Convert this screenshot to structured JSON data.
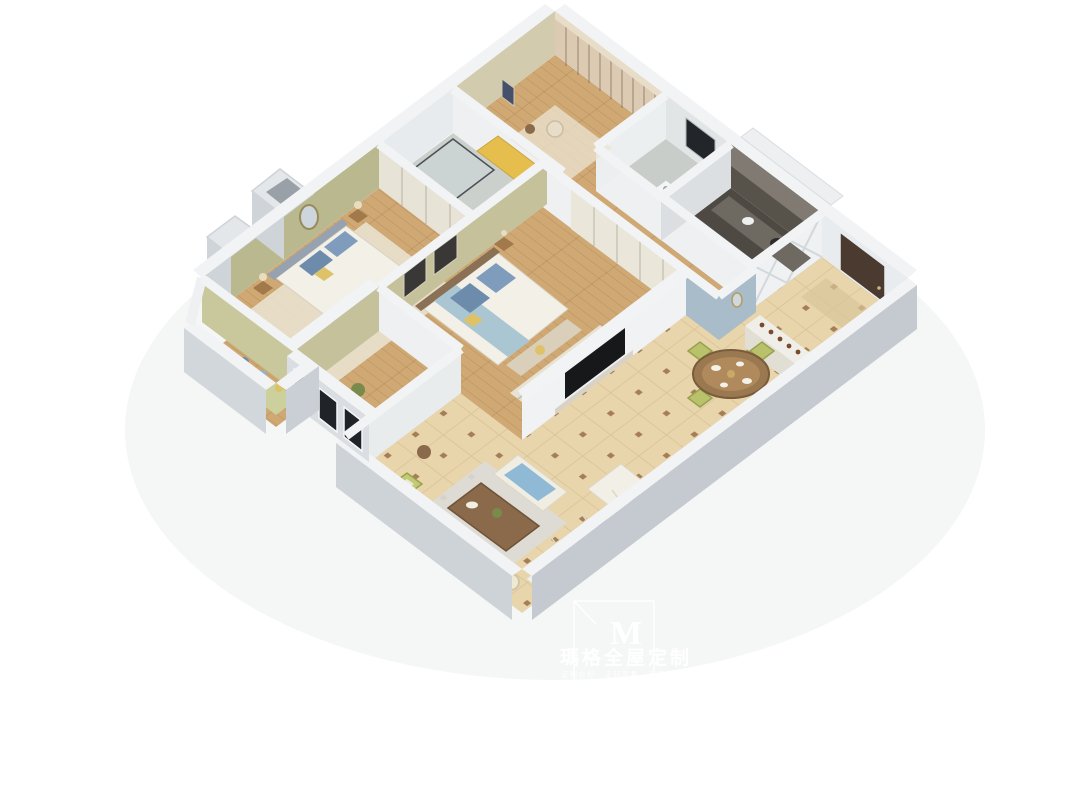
{
  "watermark": {
    "logo_letter": "M",
    "brand": "瑪格全屋定制",
    "tagline": "定制衣柜 · 定制家具 · 多空间定制"
  },
  "palette": {
    "background": "#ffffff",
    "wall_top": "#f1f3f5",
    "wall_face_light": "#dfe3e7",
    "wall_face_shadow": "#c4cad0",
    "wood_floor": "#cfa873",
    "tile_floor": "#e8d5ac",
    "tile_accent": "#8f613a",
    "olive_wall": "#b9b88e",
    "blue_panel_wall": "#a8bcca",
    "kitchen_dark": "#57534b",
    "entry_door_brown": "#4a3a30",
    "bedding_blue": "#7f9cbc",
    "accent_yellow": "#ddc268",
    "sofa_cream": "#f2efe6",
    "dining_chair_green": "#b9c26a",
    "table_wood": "#9a7850",
    "window_dark": "#202428"
  }
}
